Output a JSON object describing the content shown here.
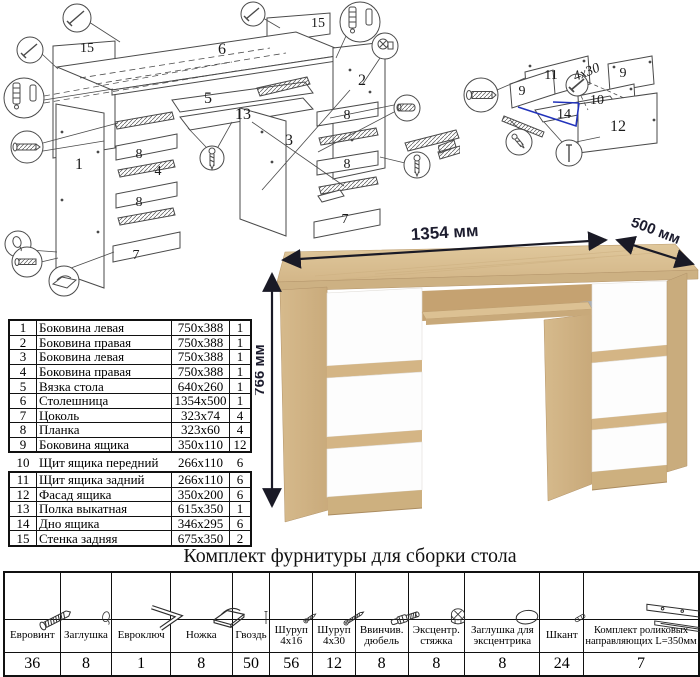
{
  "exploded_main": {
    "labels": [
      "15",
      "6",
      "15",
      "5",
      "13",
      "1",
      "3",
      "2",
      "8",
      "4",
      "8",
      "7",
      "8",
      "8",
      "7"
    ]
  },
  "exploded_drawer": {
    "labels": [
      "11",
      "9",
      "9",
      "10",
      "14",
      "12",
      "4x30"
    ]
  },
  "desk": {
    "dimensions": {
      "width": "1354 мм",
      "depth": "500 мм",
      "height": "766 мм"
    }
  },
  "parts_table": {
    "rows": [
      [
        "1",
        "Боковина левая",
        "750x388",
        "1"
      ],
      [
        "2",
        "Боковина правая",
        "750x388",
        "1"
      ],
      [
        "3",
        "Боковина левая",
        "750x388",
        "1"
      ],
      [
        "4",
        "Боковина правая",
        "750x388",
        "1"
      ],
      [
        "5",
        "Вязка стола",
        "640x260",
        "1"
      ],
      [
        "6",
        "Столешница",
        "1354x500",
        "1"
      ],
      [
        "7",
        "Цоколь",
        "323x74",
        "4"
      ],
      [
        "8",
        "Планка",
        "323x60",
        "4"
      ],
      [
        "9",
        "Боковина ящика",
        "350x110",
        "12"
      ],
      [
        "10",
        "Щит ящика передний",
        "266x110",
        "6"
      ],
      [
        "11",
        "Щит ящика задний",
        "266x110",
        "6"
      ],
      [
        "12",
        "Фасад ящика",
        "350x200",
        "6"
      ],
      [
        "13",
        "Полка выкатная",
        "615x350",
        "1"
      ],
      [
        "14",
        "Дно ящика",
        "346x295",
        "6"
      ],
      [
        "15",
        "Стенка задняя",
        "675x350",
        "2"
      ]
    ]
  },
  "hardware": {
    "title": "Комплект фурнитуры для сборки стола",
    "items": [
      {
        "icon": "eurovint",
        "label": "Евровинт",
        "qty": "36"
      },
      {
        "icon": "plug",
        "label": "Заглушка",
        "qty": "8"
      },
      {
        "icon": "hexkey",
        "label": "Евроключ",
        "qty": "1"
      },
      {
        "icon": "foot",
        "label": "Ножка",
        "qty": "8"
      },
      {
        "icon": "nail",
        "label": "Гвоздь",
        "qty": "50"
      },
      {
        "icon": "screw16",
        "label": "Шуруп 4x16",
        "qty": "56"
      },
      {
        "icon": "screw30",
        "label": "Шуруп 4x30",
        "qty": "12"
      },
      {
        "icon": "dowel-screw",
        "label": "Ввинчив. дюбель",
        "qty": "8"
      },
      {
        "icon": "cam-lock",
        "label": "Эксцентр. стяжка",
        "qty": "8"
      },
      {
        "icon": "cam-cap",
        "label": "Заглушка для эксцентрика",
        "qty": "8"
      },
      {
        "icon": "dowel",
        "label": "Шкант",
        "qty": "24"
      },
      {
        "icon": "rail-kit",
        "label": "Комплект роликовых направляющих L=350мм",
        "qty": "7"
      }
    ]
  }
}
